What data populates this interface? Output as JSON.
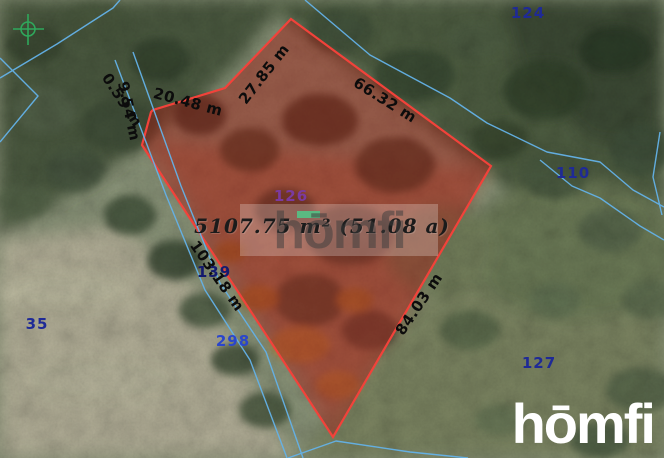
{
  "map": {
    "area_label": "5107.75 m² (51.08 a)",
    "measurements": [
      {
        "label": "27.85 m"
      },
      {
        "label": "66.32 m"
      },
      {
        "label": "84.03 m"
      },
      {
        "label": "103.18 m"
      },
      {
        "label": "20.48 m"
      },
      {
        "label": "9.54 m"
      },
      {
        "label": "0.59 m"
      }
    ],
    "parcel_numbers": [
      {
        "label": "124"
      },
      {
        "label": "126"
      },
      {
        "label": "110"
      },
      {
        "label": "139"
      },
      {
        "label": "35"
      },
      {
        "label": "298"
      },
      {
        "label": "127"
      }
    ]
  },
  "watermark": {
    "text": "hōmfi"
  },
  "logo": {
    "text": "hōmfi"
  },
  "colors": {
    "parcel_boundary_red": "#f2423a",
    "parcel_fill_red": "#a81a12",
    "cadastral_blue": "#64b2e8",
    "survey_green": "#2fa85c",
    "highlight_green": "#27a35a"
  }
}
